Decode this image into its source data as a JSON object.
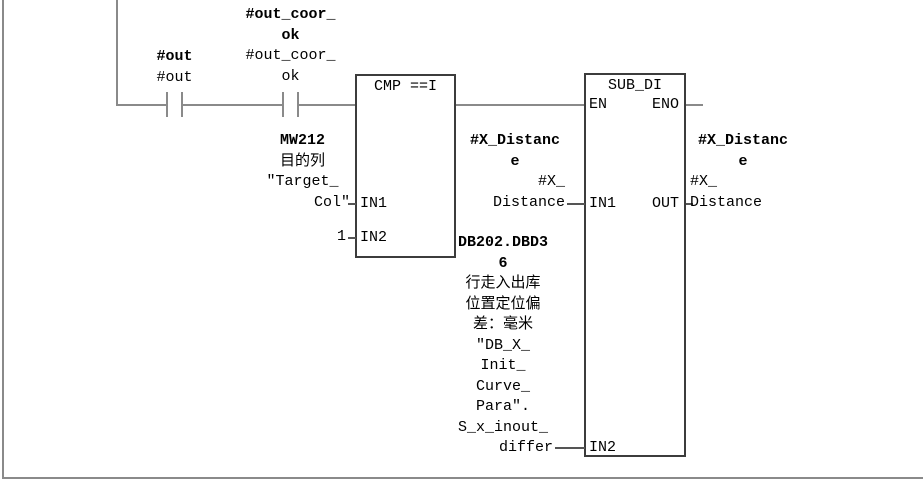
{
  "colors": {
    "background": "#ffffff",
    "wire": "#8a8a8a",
    "block_border": "#3c3c3c",
    "text": "#000000"
  },
  "network": {
    "contact1": {
      "symbol": [
        "#out"
      ],
      "operand": [
        "#out"
      ]
    },
    "contact2": {
      "symbol": [
        "#out_coor_",
        "ok"
      ],
      "operand": [
        "#out_coor_",
        "ok"
      ]
    },
    "cmp_block": {
      "title": "CMP ==I",
      "in1_label": "IN1",
      "in2_label": "IN2"
    },
    "sub_block": {
      "title": "SUB_DI",
      "en_label": "EN",
      "eno_label": "ENO",
      "in1_label": "IN1",
      "out_label": "OUT",
      "in2_label": "IN2"
    },
    "cmp_in1": {
      "address": "MW212",
      "comment": "目的列",
      "symbol": [
        "″Target_",
        "Col″"
      ]
    },
    "cmp_in2": {
      "value": "1"
    },
    "sub_in1": {
      "address": [
        "#X_Distanc",
        "e"
      ],
      "operand": [
        "#X_",
        "Distance"
      ]
    },
    "sub_in2": {
      "address": [
        "DB202.DBD3",
        "6"
      ],
      "comment": [
        "行走入出库",
        "位置定位偏",
        "差：毫米"
      ],
      "symbol": [
        "″DB_X_",
        "Init_",
        "Curve_",
        "Para″.",
        "S_x_inout_",
        "differ"
      ]
    },
    "sub_out": {
      "address": [
        "#X_Distanc",
        "e"
      ],
      "operand": [
        "#X_",
        "Distance"
      ]
    }
  }
}
